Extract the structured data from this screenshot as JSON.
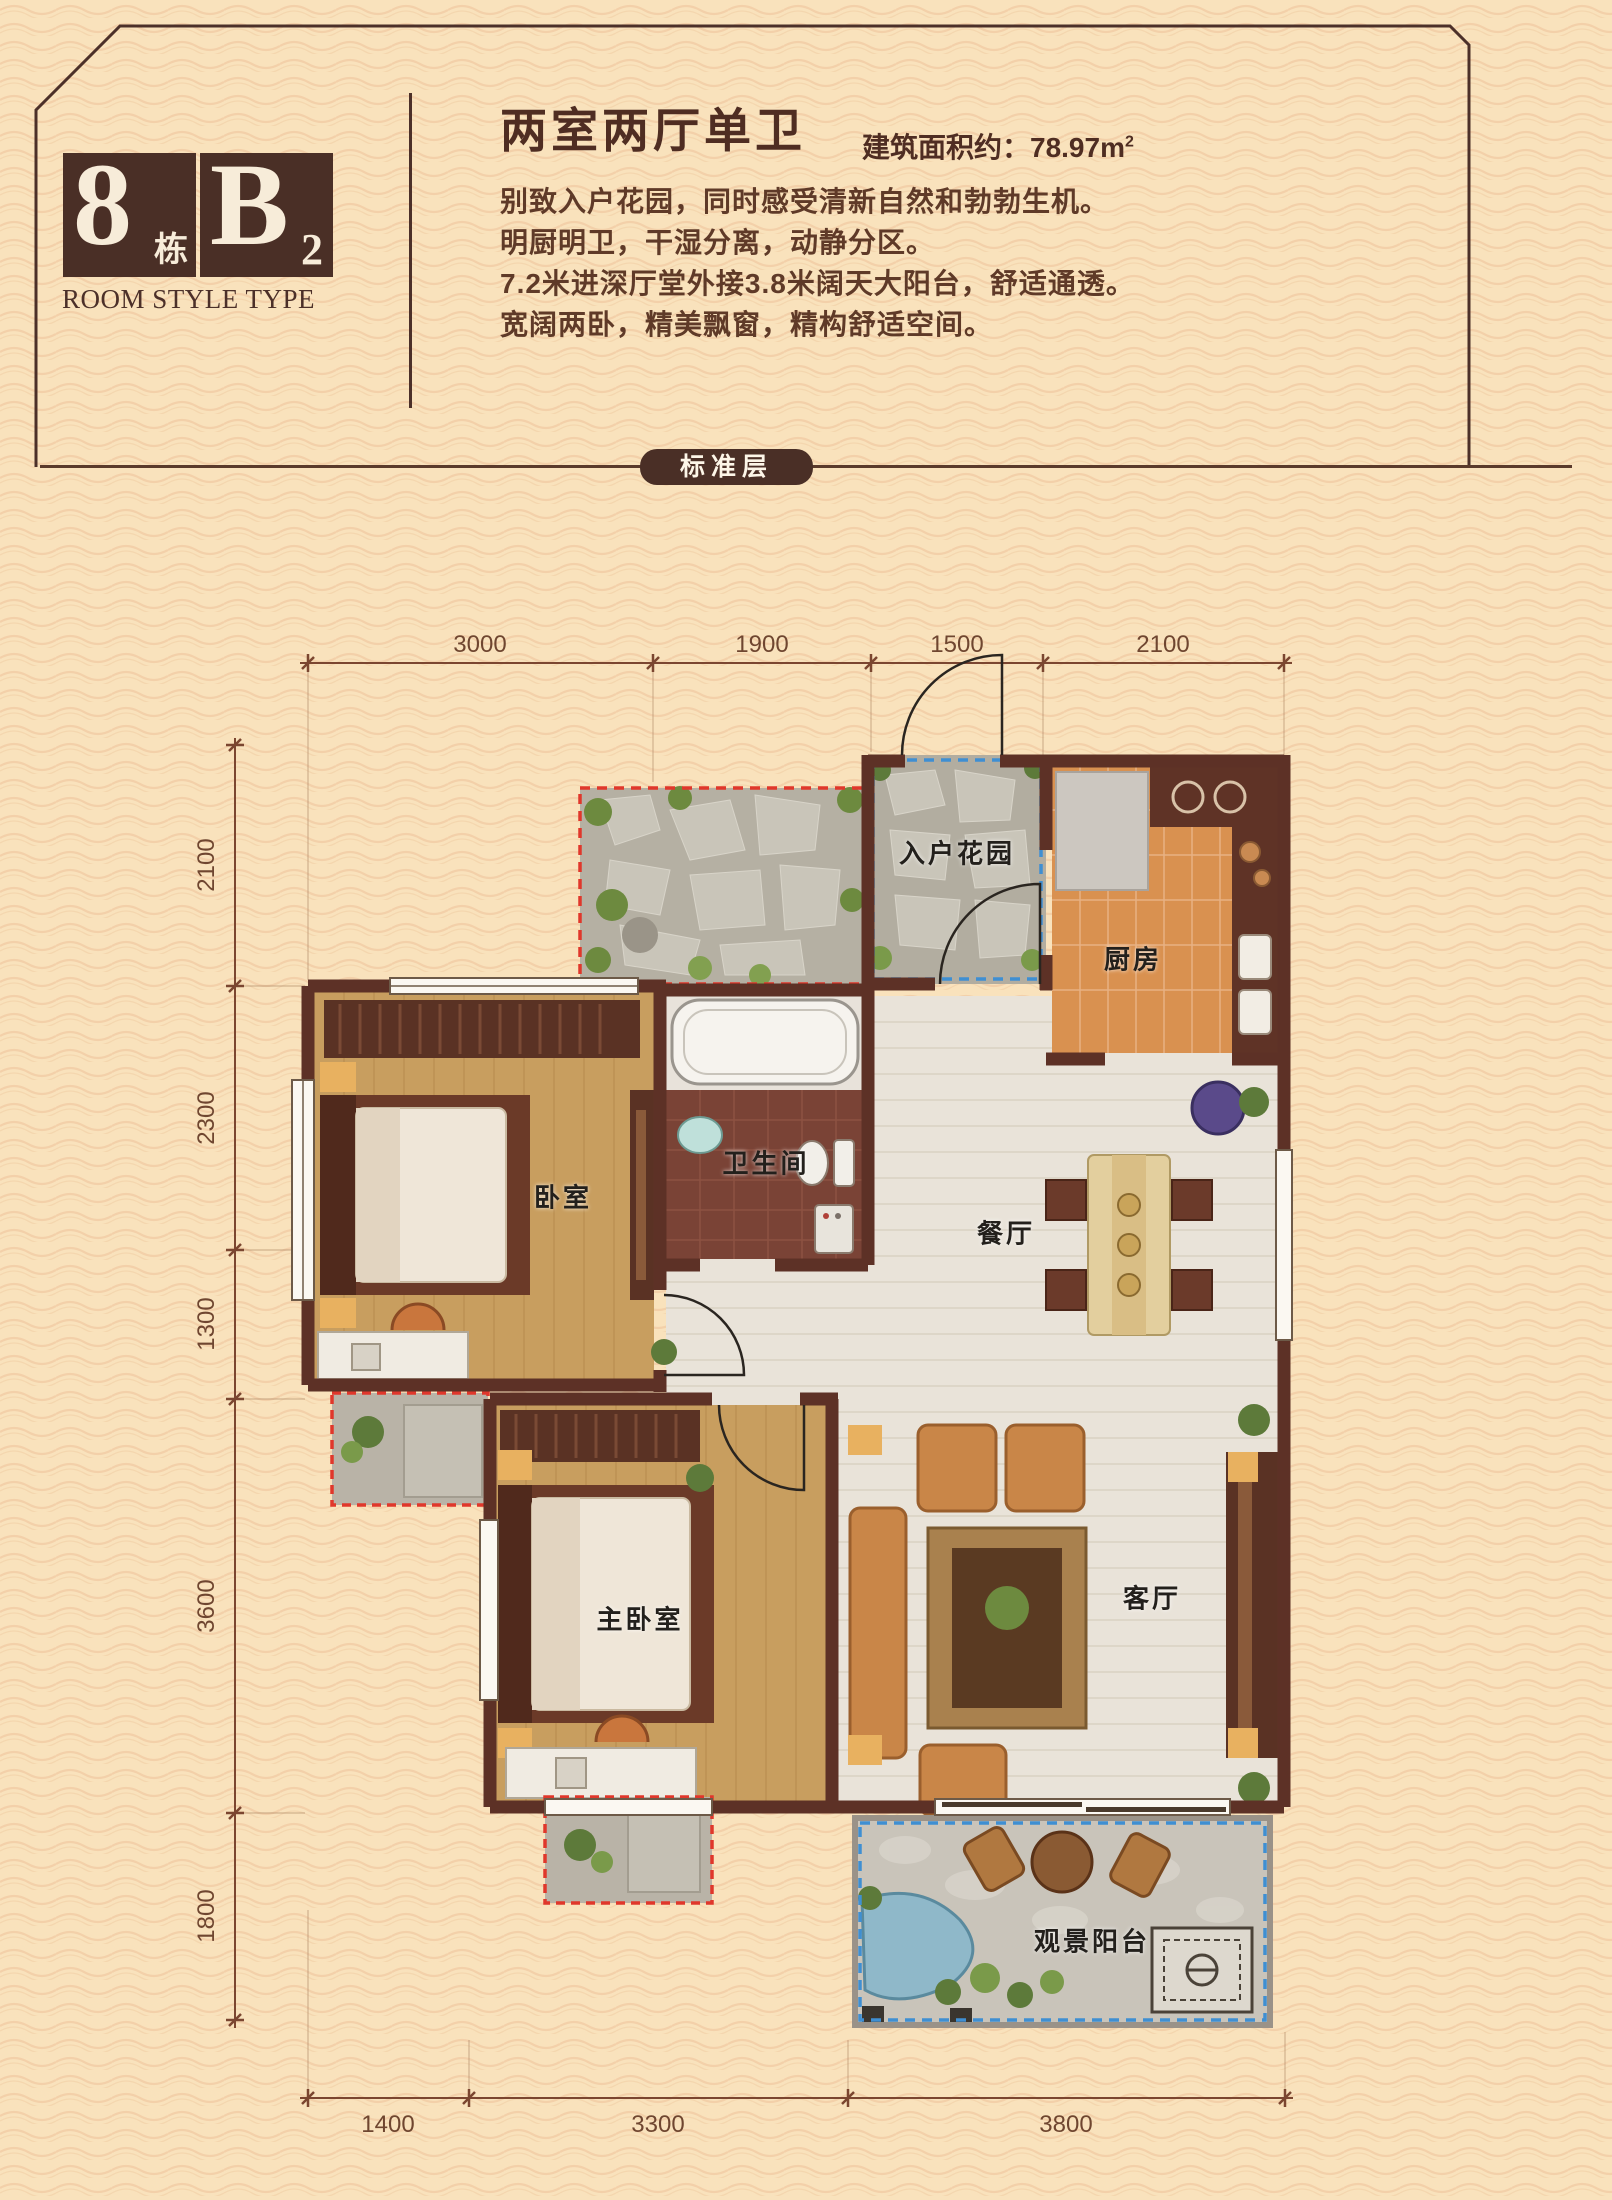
{
  "badge": {
    "building_number": "8",
    "building_suffix": "栋",
    "unit_letter": "B",
    "unit_sub": "2",
    "caption": "ROOM STYLE TYPE"
  },
  "header": {
    "title": "两室两厅单卫",
    "area_prefix": "建筑面积约：78.97",
    "area_unit_base": "m",
    "area_unit_sup": "2",
    "features": [
      "别致入户花园，同时感受清新自然和勃勃生机。",
      "明厨明卫，干湿分离，动静分区。",
      "7.2米进深厅堂外接3.8米阔天大阳台，舒适通透。",
      "宽阔两卧，精美飘窗，精构舒适空间。"
    ]
  },
  "floor_tag": "标准层",
  "plan": {
    "rooms": [
      {
        "id": "entry-garden",
        "label": "入户花园"
      },
      {
        "id": "kitchen",
        "label": "厨房"
      },
      {
        "id": "bedroom",
        "label": "卧室"
      },
      {
        "id": "bathroom",
        "label": "卫生间"
      },
      {
        "id": "dining-room",
        "label": "餐厅"
      },
      {
        "id": "master-bedroom",
        "label": "主卧室"
      },
      {
        "id": "living-room",
        "label": "客厅"
      },
      {
        "id": "view-balcony",
        "label": "观景阳台"
      }
    ],
    "dimensions": {
      "top": [
        "3000",
        "1900",
        "1500",
        "2100"
      ],
      "left": [
        "2100",
        "2300",
        "1300",
        "3600",
        "1800"
      ],
      "bottom": [
        "1400",
        "3300",
        "3800"
      ]
    }
  },
  "colors": {
    "background": "#f9e2bc",
    "wave_line": "#eec49c",
    "brand_brown": "#4a2f26",
    "wall": "#5d3126",
    "red_dash": "#e0372b",
    "blue_dash": "#3f8fd2"
  }
}
